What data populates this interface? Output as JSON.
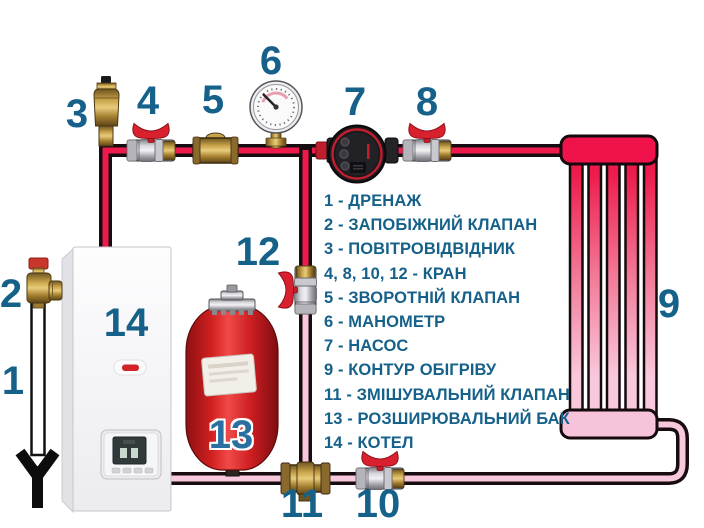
{
  "meta": {
    "type": "heating-system-piping-diagram",
    "language": "uk"
  },
  "colors": {
    "hot_pipe": "#EE1A4B",
    "cold_pipe": "#F8C8DC",
    "pipe_outline": "#170C10",
    "label_blue": "#16618A",
    "valve_handle_red": "#D8202E",
    "tank_red": "#D92227",
    "radiator_hot": "#F0134B",
    "radiator_cold": "#F7C3DA",
    "background": "#FFFFFF"
  },
  "components": {
    "drain": {
      "number": "1",
      "name": "ДРЕНАЖ"
    },
    "safety_valve": {
      "number": "2",
      "name": "ЗАПОБІЖНИЙ КЛАПАН"
    },
    "air_vent": {
      "number": "3",
      "name": "ПОВІТРОВІДВІДНИК"
    },
    "valve_supply_left": {
      "number": "4",
      "name": "КРАН"
    },
    "check_valve": {
      "number": "5",
      "name": "ЗВОРОТНІЙ КЛАПАН"
    },
    "manometer": {
      "number": "6",
      "name": "МАНОМЕТР"
    },
    "pump": {
      "number": "7",
      "name": "НАСОС"
    },
    "valve_supply_right": {
      "number": "8",
      "name": "КРАН"
    },
    "radiator": {
      "number": "9",
      "name": "КОНТУР ОБІГРІВУ"
    },
    "valve_return": {
      "number": "10",
      "name": "КРАН"
    },
    "mixing_valve": {
      "number": "11",
      "name": "ЗМІШУВАЛЬНИЙ КЛАПАН"
    },
    "valve_bypass": {
      "number": "12",
      "name": "КРАН"
    },
    "expansion_tank": {
      "number": "13",
      "name": "РОЗШИРЮВАЛЬНИЙ БАК"
    },
    "boiler": {
      "number": "14",
      "name": "КОТЕЛ"
    }
  },
  "legend": {
    "items": [
      "1 - ДРЕНАЖ",
      "2 - ЗАПОБІЖНИЙ КЛАПАН",
      "3 - ПОВІТРОВІДВІДНИК",
      "4, 8, 10, 12 - КРАН",
      "5 - ЗВОРОТНІЙ КЛАПАН",
      "6 - МАНОМЕТР",
      "7 - НАСОС",
      "9 - КОНТУР ОБІГРІВУ",
      "11 - ЗМІШУВАЛЬНИЙ КЛАПАН",
      "13 - РОЗШИРЮВАЛЬНИЙ БАК",
      "14 - КОТЕЛ"
    ]
  }
}
